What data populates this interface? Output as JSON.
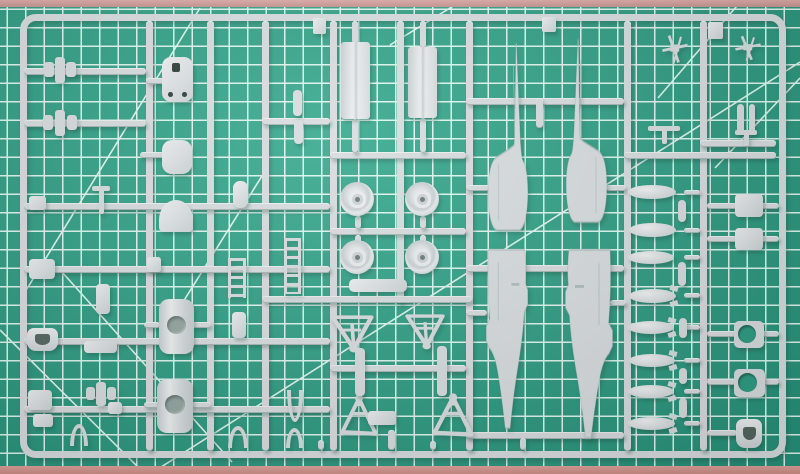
{
  "scene": {
    "description": "Photograph of a light grey injection-moulded model aircraft sprue (fuselage halves, wheels, drop tanks, bombs, doors, ladders and small detail parts) lying on a green self-healing cutting mat with a white grid",
    "mat": {
      "base_color": "#2E9C82",
      "base_highlight": "#38A98E",
      "base_shadow": "#28927A",
      "grid_color": "#DFF6EF",
      "grid_spacing_px": 18.5,
      "grid_offset": [
        8,
        10
      ],
      "edge_top_color": "#D8A5A2",
      "edge_bottom_color": "#D99A92",
      "diagonals": [
        [
          0,
          330,
          145,
          474
        ],
        [
          62,
          272,
          232,
          462
        ],
        [
          25,
          292,
          200,
          8
        ],
        [
          183,
          302,
          262,
          176
        ],
        [
          150,
          474,
          800,
          62
        ],
        [
          658,
          98,
          742,
          0
        ],
        [
          715,
          168,
          800,
          78
        ],
        [
          390,
          45,
          463,
          0
        ]
      ]
    },
    "sprue": {
      "plastic_color": "#D7DCDE",
      "plastic_dark": "#AEBDBB",
      "cast_shadow": "rgba(25,70,58,0.30)",
      "frame": {
        "x": 20,
        "y": 14,
        "w": 766,
        "h": 444,
        "radius": 16
      },
      "runners": [
        [
          146,
          21,
          7,
          430
        ],
        [
          207,
          21,
          7,
          430
        ],
        [
          262,
          21,
          7,
          430
        ],
        [
          330,
          21,
          7,
          430
        ],
        [
          397,
          21,
          7,
          282
        ],
        [
          466,
          21,
          7,
          430
        ],
        [
          624,
          21,
          7,
          430
        ],
        [
          700,
          21,
          7,
          430
        ],
        [
          24,
          68,
          122,
          7
        ],
        [
          24,
          120,
          122,
          7
        ],
        [
          24,
          203,
          306,
          7
        ],
        [
          24,
          266,
          306,
          7
        ],
        [
          24,
          338,
          306,
          7
        ],
        [
          24,
          406,
          306,
          7
        ],
        [
          262,
          118,
          68,
          7
        ],
        [
          330,
          152,
          136,
          7
        ],
        [
          330,
          228,
          136,
          7
        ],
        [
          262,
          296,
          210,
          7
        ],
        [
          330,
          365,
          136,
          7
        ],
        [
          466,
          98,
          158,
          7
        ],
        [
          466,
          265,
          158,
          7
        ],
        [
          466,
          432,
          158,
          7
        ],
        [
          624,
          152,
          152,
          7
        ],
        [
          700,
          140,
          76,
          7
        ],
        [
          146,
          78,
          18,
          6
        ],
        [
          140,
          152,
          24,
          6
        ],
        [
          144,
          322,
          16,
          6
        ],
        [
          191,
          322,
          20,
          6
        ],
        [
          144,
          402,
          15,
          6
        ],
        [
          191,
          402,
          20,
          6
        ],
        [
          352,
          21,
          6,
          23
        ],
        [
          420,
          21,
          6,
          27
        ],
        [
          352,
          119,
          6,
          34
        ],
        [
          420,
          118,
          6,
          35
        ],
        [
          355,
          216,
          6,
          13
        ],
        [
          420,
          216,
          6,
          13
        ],
        [
          355,
          235,
          6,
          12
        ],
        [
          420,
          235,
          6,
          12
        ],
        [
          466,
          185,
          24,
          6
        ],
        [
          466,
          310,
          21,
          6
        ],
        [
          606,
          185,
          20,
          6
        ],
        [
          610,
          300,
          16,
          6
        ],
        [
          536,
          98,
          7,
          30
        ],
        [
          707,
          203,
          30,
          6
        ],
        [
          761,
          203,
          18,
          6
        ],
        [
          707,
          236,
          30,
          6
        ],
        [
          761,
          236,
          18,
          6
        ],
        [
          707,
          331,
          29,
          6
        ],
        [
          762,
          331,
          17,
          6
        ],
        [
          707,
          379,
          29,
          6
        ],
        [
          762,
          379,
          17,
          6
        ],
        [
          707,
          430,
          30,
          6
        ],
        [
          684,
          190,
          16,
          5
        ],
        [
          684,
          228,
          16,
          5
        ],
        [
          684,
          255,
          16,
          5
        ],
        [
          684,
          293,
          16,
          5
        ],
        [
          684,
          325,
          16,
          5
        ],
        [
          684,
          358,
          16,
          5
        ],
        [
          684,
          389,
          16,
          5
        ],
        [
          684,
          421,
          16,
          5
        ],
        [
          388,
          430,
          7,
          20
        ],
        [
          318,
          440,
          6,
          10
        ],
        [
          430,
          441,
          6,
          9
        ],
        [
          520,
          438,
          6,
          12
        ]
      ],
      "parts": [
        {
          "n": "small-winged-part-1",
          "t": "winged",
          "x": 44,
          "y": 57,
          "w": 32,
          "h": 26
        },
        {
          "n": "small-winged-part-2",
          "t": "winged",
          "x": 43,
          "y": 110,
          "w": 34,
          "h": 26
        },
        {
          "n": "access-panel-with-holes",
          "t": "plate2holes",
          "x": 162,
          "y": 57,
          "w": 31,
          "h": 45
        },
        {
          "n": "rounded-hatch",
          "t": "blob",
          "x": 162,
          "y": 140,
          "w": 30,
          "h": 34,
          "r": 10
        },
        {
          "n": "dome-part",
          "t": "dome",
          "x": 159,
          "y": 200,
          "w": 34,
          "h": 32
        },
        {
          "n": "small-bracket-1",
          "t": "blob",
          "x": 29,
          "y": 196,
          "w": 17,
          "h": 14,
          "r": 3
        },
        {
          "n": "antenna-mast",
          "t": "tbar",
          "x": 92,
          "y": 186,
          "w": 18,
          "h": 28
        },
        {
          "n": "spoon-shaped-part",
          "t": "blob",
          "x": 233,
          "y": 181,
          "w": 15,
          "h": 27,
          "r": 7
        },
        {
          "n": "small-bracket-2",
          "t": "blob",
          "x": 29,
          "y": 259,
          "w": 26,
          "h": 20,
          "r": 4
        },
        {
          "n": "small-bracket-3",
          "t": "blob",
          "x": 147,
          "y": 257,
          "w": 14,
          "h": 15,
          "r": 3
        },
        {
          "n": "small-part-strip",
          "t": "blob",
          "x": 96,
          "y": 284,
          "w": 14,
          "h": 30,
          "r": 4
        },
        {
          "n": "vertical-rod-1",
          "t": "rod",
          "x": 293,
          "y": 90,
          "w": 9,
          "h": 26
        },
        {
          "n": "vertical-rod-2",
          "t": "rod",
          "x": 294,
          "y": 120,
          "w": 9,
          "h": 24
        },
        {
          "n": "pilot-seat",
          "t": "seat2",
          "x": 27,
          "y": 328,
          "w": 31,
          "h": 23
        },
        {
          "n": "flat-strip",
          "t": "blob",
          "x": 84,
          "y": 341,
          "w": 33,
          "h": 12,
          "r": 4
        },
        {
          "n": "intake-cover-1",
          "t": "cylinder",
          "x": 159,
          "y": 299,
          "w": 35,
          "h": 55
        },
        {
          "n": "intake-cover-2",
          "t": "cylinder",
          "x": 157,
          "y": 379,
          "w": 36,
          "h": 54
        },
        {
          "n": "boarding-ladder-1",
          "t": "ladder",
          "x": 228,
          "y": 258,
          "w": 18,
          "h": 40
        },
        {
          "n": "boarding-ladder-2",
          "t": "ladder",
          "x": 284,
          "y": 238,
          "w": 17,
          "h": 56
        },
        {
          "n": "small-pylon-part",
          "t": "blob",
          "x": 232,
          "y": 312,
          "w": 14,
          "h": 26,
          "r": 4
        },
        {
          "n": "small-cluster-1",
          "t": "blob",
          "x": 28,
          "y": 390,
          "w": 24,
          "h": 20,
          "r": 4
        },
        {
          "n": "small-winged-part-3",
          "t": "winged",
          "x": 86,
          "y": 382,
          "w": 30,
          "h": 24
        },
        {
          "n": "small-cluster-2",
          "t": "blob",
          "x": 33,
          "y": 414,
          "w": 20,
          "h": 13,
          "r": 3
        },
        {
          "n": "small-cluster-3",
          "t": "blob",
          "x": 108,
          "y": 402,
          "w": 14,
          "h": 12,
          "r": 3
        },
        {
          "n": "wheel-well-arch-1",
          "t": "arch",
          "x": 70,
          "y": 424,
          "w": 18,
          "h": 22
        },
        {
          "n": "wheel-well-arch-2",
          "t": "arch",
          "x": 228,
          "y": 426,
          "w": 20,
          "h": 22
        },
        {
          "n": "wheel-well-arch-3",
          "t": "arch",
          "x": 286,
          "y": 428,
          "w": 17,
          "h": 20
        },
        {
          "n": "fork-part",
          "t": "fork",
          "x": 287,
          "y": 390,
          "w": 16,
          "h": 32
        },
        {
          "n": "frame-tab-1",
          "t": "blob",
          "x": 313,
          "y": 18,
          "w": 13,
          "h": 16,
          "r": 2
        },
        {
          "n": "frame-tab-2",
          "t": "blob",
          "x": 542,
          "y": 17,
          "w": 14,
          "h": 15,
          "r": 2
        },
        {
          "n": "frame-tab-3",
          "t": "blob",
          "x": 708,
          "y": 22,
          "w": 15,
          "h": 17,
          "r": 2
        },
        {
          "n": "gear-door-panel-1",
          "t": "panel",
          "x": 341,
          "y": 42,
          "w": 29,
          "h": 77
        },
        {
          "n": "gear-door-panel-2",
          "t": "panel",
          "x": 408,
          "y": 47,
          "w": 29,
          "h": 71
        },
        {
          "n": "main-wheel-1",
          "t": "wheel",
          "x": 340,
          "y": 182,
          "w": 34,
          "h": 34
        },
        {
          "n": "main-wheel-2",
          "t": "wheel",
          "x": 405,
          "y": 182,
          "w": 34,
          "h": 34
        },
        {
          "n": "main-wheel-3",
          "t": "wheel",
          "x": 340,
          "y": 240,
          "w": 34,
          "h": 34
        },
        {
          "n": "main-wheel-4",
          "t": "wheel",
          "x": 405,
          "y": 240,
          "w": 34,
          "h": 34
        },
        {
          "n": "flat-fairing",
          "t": "blob",
          "x": 349,
          "y": 279,
          "w": 58,
          "h": 13,
          "r": 5
        },
        {
          "n": "gear-frame-1",
          "t": "tri",
          "x": 329,
          "y": 315,
          "w": 46,
          "h": 36,
          "o": "down"
        },
        {
          "n": "gear-frame-2",
          "t": "tri",
          "x": 404,
          "y": 314,
          "w": 42,
          "h": 34,
          "o": "down"
        },
        {
          "n": "gear-frame-3",
          "t": "tri",
          "x": 340,
          "y": 396,
          "w": 38,
          "h": 42,
          "o": "up"
        },
        {
          "n": "gear-frame-4",
          "t": "tri",
          "x": 432,
          "y": 395,
          "w": 42,
          "h": 44,
          "o": "up"
        },
        {
          "n": "link-rod-1",
          "t": "rod",
          "x": 355,
          "y": 348,
          "w": 10,
          "h": 48
        },
        {
          "n": "link-rod-2",
          "t": "rod",
          "x": 437,
          "y": 346,
          "w": 10,
          "h": 50
        },
        {
          "n": "center-fairing",
          "t": "blob",
          "x": 368,
          "y": 411,
          "w": 28,
          "h": 14,
          "r": 3
        },
        {
          "n": "fuselage-front-left",
          "t": "fusefront",
          "x": 487,
          "y": 42,
          "w": 42,
          "h": 190
        },
        {
          "n": "fuselage-rear-left",
          "t": "fuserear",
          "x": 485,
          "y": 248,
          "w": 44,
          "h": 182
        },
        {
          "n": "fuselage-front-right",
          "t": "fusefront",
          "x": 565,
          "y": 38,
          "w": 43,
          "h": 186,
          "flip": 1
        },
        {
          "n": "fuselage-rear-right",
          "t": "fuserear",
          "x": 564,
          "y": 248,
          "w": 50,
          "h": 192,
          "flip": 1
        },
        {
          "n": "landing-gear-leg-1",
          "t": "xpart",
          "x": 660,
          "y": 33,
          "w": 30,
          "h": 32
        },
        {
          "n": "landing-gear-leg-2",
          "t": "xpart",
          "x": 733,
          "y": 34,
          "w": 30,
          "h": 28
        },
        {
          "n": "pin-part-1",
          "t": "rod",
          "x": 737,
          "y": 104,
          "w": 7,
          "h": 30
        },
        {
          "n": "pin-part-2",
          "t": "rod",
          "x": 749,
          "y": 104,
          "w": 6,
          "h": 30
        },
        {
          "n": "pitot-t-part-1",
          "t": "tbar",
          "x": 648,
          "y": 126,
          "w": 32,
          "h": 18
        },
        {
          "n": "pitot-t-part-2",
          "t": "tbar",
          "x": 735,
          "y": 130,
          "w": 22,
          "h": 16
        },
        {
          "n": "drop-tank-1",
          "t": "tank",
          "x": 628,
          "y": 185,
          "w": 48,
          "h": 14
        },
        {
          "n": "drop-tank-2",
          "t": "tank",
          "x": 629,
          "y": 223,
          "w": 47,
          "h": 14
        },
        {
          "n": "drop-tank-3",
          "t": "tank",
          "x": 628,
          "y": 251,
          "w": 46,
          "h": 13
        },
        {
          "n": "bomb-1",
          "t": "tank",
          "x": 629,
          "y": 289,
          "w": 47,
          "h": 14,
          "fins": 1
        },
        {
          "n": "bomb-2",
          "t": "tank",
          "x": 628,
          "y": 321,
          "w": 46,
          "h": 13,
          "fins": 1
        },
        {
          "n": "bomb-3",
          "t": "tank",
          "x": 629,
          "y": 354,
          "w": 46,
          "h": 13,
          "fins": 1
        },
        {
          "n": "bomb-4",
          "t": "tank",
          "x": 628,
          "y": 385,
          "w": 46,
          "h": 13,
          "fins": 1
        },
        {
          "n": "bomb-5",
          "t": "tank",
          "x": 628,
          "y": 417,
          "w": 47,
          "h": 13,
          "fins": 1
        },
        {
          "n": "pylon-1",
          "t": "rod",
          "x": 678,
          "y": 200,
          "w": 8,
          "h": 22
        },
        {
          "n": "pylon-2",
          "t": "rod",
          "x": 678,
          "y": 262,
          "w": 8,
          "h": 24
        },
        {
          "n": "pylon-3",
          "t": "rod",
          "x": 679,
          "y": 318,
          "w": 8,
          "h": 20
        },
        {
          "n": "pylon-4",
          "t": "rod",
          "x": 679,
          "y": 368,
          "w": 8,
          "h": 16
        },
        {
          "n": "pylon-5",
          "t": "rod",
          "x": 679,
          "y": 398,
          "w": 8,
          "h": 20
        },
        {
          "n": "equipment-box-1",
          "t": "blob",
          "x": 735,
          "y": 194,
          "w": 28,
          "h": 23,
          "r": 4
        },
        {
          "n": "equipment-box-2",
          "t": "blob",
          "x": 735,
          "y": 228,
          "w": 28,
          "h": 22,
          "r": 4
        },
        {
          "n": "intake-ring-1",
          "t": "ring",
          "x": 734,
          "y": 321,
          "w": 30,
          "h": 27
        },
        {
          "n": "intake-ring-2",
          "t": "ring",
          "x": 734,
          "y": 369,
          "w": 31,
          "h": 28
        },
        {
          "n": "ejection-seat",
          "t": "seat2",
          "x": 736,
          "y": 419,
          "w": 26,
          "h": 29
        }
      ]
    }
  }
}
